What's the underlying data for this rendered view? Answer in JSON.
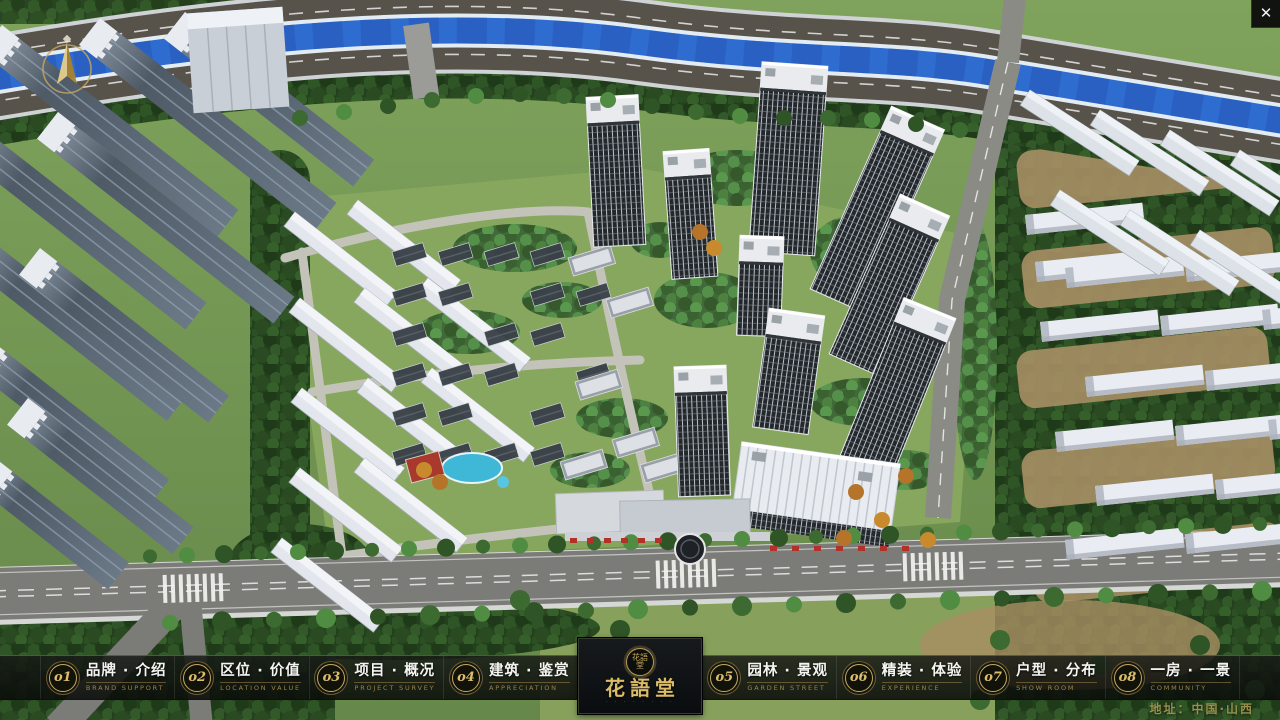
{
  "window": {
    "close_glyph": "✕"
  },
  "nav": {
    "items": [
      {
        "num": "o1",
        "zh": "品牌 · 介绍",
        "en": "BRAND SUPPORT"
      },
      {
        "num": "o2",
        "zh": "区位 · 价值",
        "en": "LOCATION VALUE"
      },
      {
        "num": "o3",
        "zh": "项目 · 概况",
        "en": "PROJECT SURVEY"
      },
      {
        "num": "o4",
        "zh": "建筑 · 鉴赏",
        "en": "APPRECIATION"
      },
      {
        "num": "o5",
        "zh": "园林 · 景观",
        "en": "GARDEN STREET"
      },
      {
        "num": "o6",
        "zh": "精装 · 体验",
        "en": "EXPERIENCE"
      },
      {
        "num": "o7",
        "zh": "户型 · 分布",
        "en": "SHOW ROOM"
      },
      {
        "num": "o8",
        "zh": "一房 · 一景",
        "en": "COMMUNITY"
      }
    ],
    "logo": {
      "seal": "花語堂",
      "title": "花語堂",
      "subtitle": "· · · · · · · ·"
    },
    "address": "地址：中国·山西"
  },
  "colors": {
    "gold": "#c8a95f",
    "gold_dim": "#9c8347",
    "bar_bg": "#101210",
    "river_blue": "#2f6cd0",
    "canopy_green": "#2a4a21",
    "accent_red": "#b03228"
  },
  "icons": {
    "compass": "north-arrow",
    "close": "close-x"
  }
}
